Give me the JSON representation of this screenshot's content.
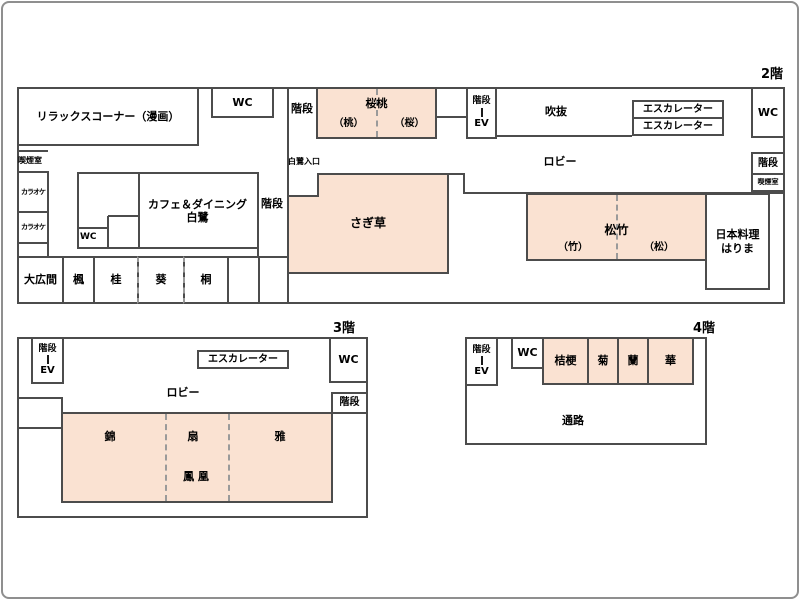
{
  "colors": {
    "room_fill": "#FAE2D2",
    "line": "#4C4C4C",
    "bracket_blue": "#7096C8"
  },
  "floor2": {
    "title": "2階",
    "relax_corner": "リラックスコーナー（漫画）",
    "wc_top_left": "WC",
    "stairs_top": "階段",
    "room_outo": {
      "name": "桜桃",
      "sub_left": "（桃）",
      "sub_right": "（桜）"
    },
    "stairs_ev": {
      "stairs": "階段",
      "ev": "EV"
    },
    "atrium": "吹抜",
    "escalator_1": "エスカレーター",
    "escalator_2": "エスカレーター",
    "wc_top_right": "WC",
    "lobby": "ロビー",
    "stairs_right": "階段",
    "smoking_right": "喫煙室",
    "entrance": "白鷺入口",
    "room_sagikusa": "さぎ草",
    "cafe_line1": "カフェ＆ダイニング",
    "cafe_line2": "白鷺",
    "cafe_wc": "WC",
    "stairs_mid": "階段",
    "smoking_left": "喫煙室",
    "karaoke_1": "カラオケ",
    "karaoke_2": "カラオケ",
    "room_ohiroma": "大広間",
    "room_kaede": "楓",
    "room_katsura": "桂",
    "room_aoi": "葵",
    "room_kiri": "桐",
    "room_shochiku": {
      "name": "松竹",
      "sub_left": "（竹）",
      "sub_right": "（松）"
    },
    "restaurant_line1": "日本料理",
    "restaurant_line2": "はりま"
  },
  "floor3": {
    "title": "3階",
    "stairs_ev": {
      "stairs": "階段",
      "ev": "EV"
    },
    "escalator": "エスカレーター",
    "wc": "WC",
    "lobby": "ロビー",
    "stairs_right": "階段",
    "room_nishiki": "錦",
    "room_ogi": "扇",
    "room_miyabi": "雅",
    "room_hoo": "鳳 凰"
  },
  "floor4": {
    "title": "4階",
    "stairs_ev": {
      "stairs": "階段",
      "ev": "EV"
    },
    "wc": "WC",
    "room_kikyo": "桔梗",
    "room_kiku": "菊",
    "room_ran": "蘭",
    "room_hana": "華",
    "passage": "通路"
  }
}
